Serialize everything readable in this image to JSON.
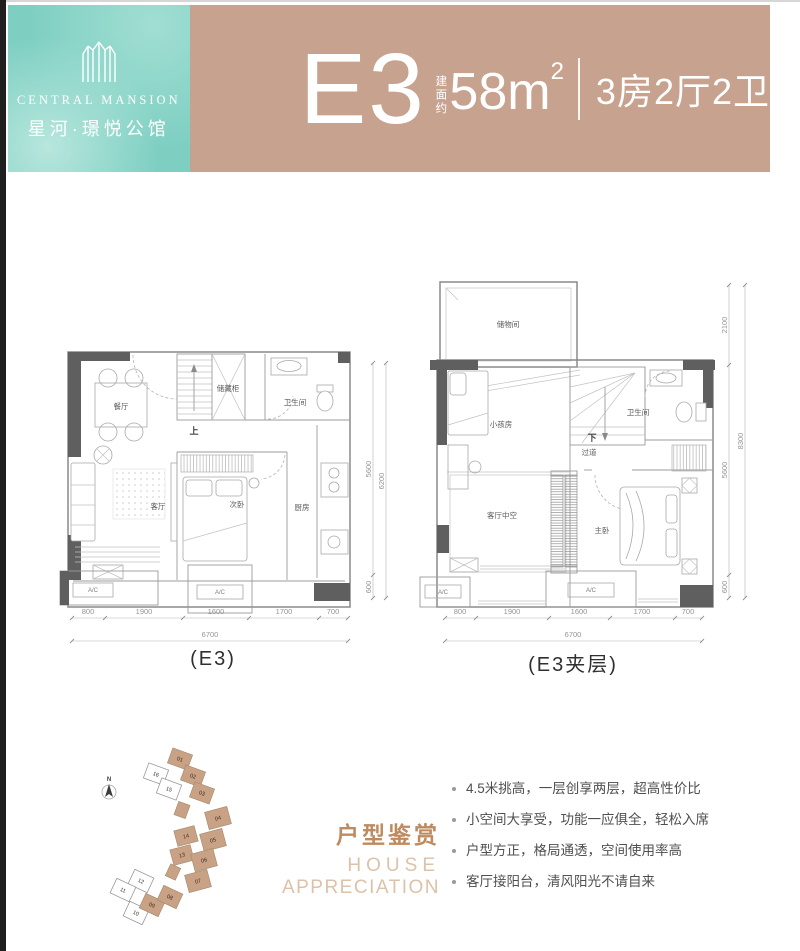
{
  "header": {
    "brand_en": "CENTRAL MANSION",
    "brand_cn": "星河·璟悦公馆",
    "unit_code": "E3",
    "area_prefix": "建面约",
    "area_value": "58m",
    "area_sup": "2",
    "layout_desc": "3房2厅2卫"
  },
  "plans": {
    "lower": {
      "caption": "(E3)",
      "rooms": {
        "dining": "餐厅",
        "storage_cabinet": "储藏柜",
        "up": "上",
        "bath": "卫生间",
        "living": "客厅",
        "bedroom2": "次卧",
        "kitchen": "厨房",
        "ac": "A/C"
      },
      "dims_bottom": [
        "800",
        "1900",
        "1600",
        "1700",
        "700"
      ],
      "dims_total": "6700",
      "dims_right": [
        "5600",
        "600"
      ],
      "dims_right_total": "6200"
    },
    "mezz": {
      "caption": "(E3夹层)",
      "rooms": {
        "storeroom": "储物间",
        "kids": "小孩房",
        "down": "下",
        "corridor": "过道",
        "bath": "卫生间",
        "void": "客厅中空",
        "master": "主卧",
        "ac": "A/C"
      },
      "dims_bottom": [
        "800",
        "1900",
        "1600",
        "1700",
        "700"
      ],
      "dims_total": "6700",
      "dims_right": [
        "2100",
        "5600",
        "600"
      ],
      "dims_right_total": "8300"
    }
  },
  "site_plan": {
    "north": "N",
    "units": [
      "01",
      "02",
      "03",
      "04",
      "05",
      "06",
      "07",
      "08",
      "09",
      "10",
      "11",
      "12",
      "13",
      "14",
      "15",
      "16"
    ]
  },
  "apprec": {
    "title_cn": "户型鉴赏",
    "title_en_1": "HOUSE",
    "title_en_2": "APPRECIATION",
    "bullets": [
      "4.5米挑高，一层创享两层，超高性价比",
      "小空间大享受，功能一应俱全，轻松入席",
      "户型方正，格局通透，空间使用率高",
      "客厅接阳台，清风阳光不请自来"
    ]
  },
  "colors": {
    "teal": "#7ecfc2",
    "header_tan": "#c7a28e",
    "site_tan": "#c9a184",
    "title_accent": "#bf8a5e",
    "title_accent_light": "#dcc2a8"
  }
}
